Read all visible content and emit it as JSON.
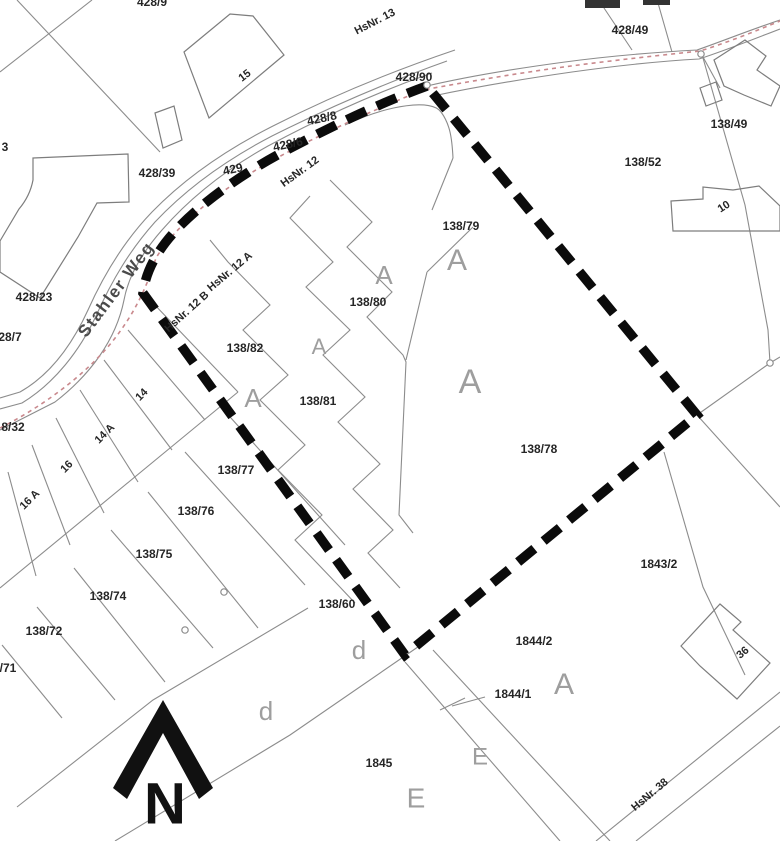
{
  "map": {
    "width": 780,
    "height": 841,
    "colors": {
      "background": "#ffffff",
      "thin_line": "#8c8c8c",
      "building_line": "#7d7d7d",
      "boundary": "#0b0b0b",
      "pink_dash": "#c9898d",
      "number_text": "#262626",
      "gray_letter": "#9e9e9e",
      "street_text": "#4a4a4a",
      "north": "#111111"
    },
    "boundary_outline": {
      "path": "M427,86 C380,103 330,127 285,151 C245,172 205,200 178,228 C158,249 146,270 143,293 L405,655 L697,415 Z",
      "stroke_width": 9.5,
      "dash": "21 12"
    },
    "pink_boundary": {
      "path": "M0,428 C40,408 92,372 121,330 C139,305 149,280 156,258 C176,225 216,193 266,164 C316,136 371,111 423,90 C471,81 526,72 571,66 C616,60 663,55 700,51 C726,43 756,31 780,21",
      "dash": "4 4",
      "stroke_width": 1.6
    },
    "road_paths": [
      "M455,50 C390,72 330,97 275,125 C225,150 185,178 152,212 C125,240 105,272 88,310 C72,345 50,375 20,392 L0,398",
      "M447,61 C385,83 328,108 272,136 C224,161 186,189 155,222 C130,250 112,280 96,316 C80,350 55,383 22,403 L0,409",
      "M432,73 C375,93 320,118 268,146 C225,170 190,198 162,230 C140,255 128,278 124,300 C116,340 90,375 55,402 L0,430",
      "M427,86 C470,76 520,68 565,62 C610,56 660,52 697,50 C720,42 750,30 780,20",
      "M433,96 C480,86 530,78 572,72 C615,66 662,61 699,59 C724,51 754,39 780,29",
      "M345,125 C390,104 432,99 441,112 C450,124 452,138 453,158"
    ],
    "parcel_polylines": [
      [
        [
          17,
          0
        ],
        [
          160,
          152
        ]
      ],
      [
        [
          92,
          0
        ],
        [
          0,
          72
        ]
      ],
      [
        [
          453,
          158
        ],
        [
          432,
          210
        ]
      ],
      [
        [
          238,
          392
        ],
        [
          0,
          588
        ]
      ],
      [
        [
          152,
          302
        ],
        [
          238,
          392
        ]
      ],
      [
        [
          128,
          330
        ],
        [
          205,
          420
        ]
      ],
      [
        [
          104,
          360
        ],
        [
          172,
          450
        ]
      ],
      [
        [
          80,
          390
        ],
        [
          138,
          482
        ]
      ],
      [
        [
          56,
          418
        ],
        [
          104,
          513
        ]
      ],
      [
        [
          32,
          445
        ],
        [
          70,
          545
        ]
      ],
      [
        [
          8,
          472
        ],
        [
          36,
          576
        ]
      ],
      [
        [
          222,
          408
        ],
        [
          345,
          545
        ]
      ],
      [
        [
          185,
          452
        ],
        [
          305,
          585
        ]
      ],
      [
        [
          148,
          492
        ],
        [
          258,
          628
        ]
      ],
      [
        [
          111,
          530
        ],
        [
          213,
          648
        ]
      ],
      [
        [
          74,
          568
        ],
        [
          165,
          682
        ]
      ],
      [
        [
          37,
          607
        ],
        [
          115,
          700
        ]
      ],
      [
        [
          2,
          645
        ],
        [
          62,
          718
        ]
      ],
      [
        [
          308,
          608
        ],
        [
          153,
          700
        ],
        [
          17,
          807
        ]
      ],
      [
        [
          428,
          640
        ],
        [
          290,
          735
        ],
        [
          115,
          841
        ]
      ],
      [
        [
          405,
          662
        ],
        [
          560,
          841
        ]
      ],
      [
        [
          433,
          650
        ],
        [
          610,
          841
        ]
      ],
      [
        [
          485,
          697
        ],
        [
          452,
          706
        ]
      ],
      [
        [
          440,
          710
        ],
        [
          465,
          698
        ]
      ],
      [
        [
          596,
          841
        ],
        [
          780,
          692
        ]
      ],
      [
        [
          636,
          841
        ],
        [
          780,
          726
        ]
      ],
      [
        [
          697,
          415
        ],
        [
          780,
          507
        ]
      ],
      [
        [
          664,
          452
        ],
        [
          703,
          587
        ],
        [
          745,
          675
        ]
      ],
      [
        [
          703,
          58
        ],
        [
          745,
          205
        ],
        [
          768,
          330
        ],
        [
          770,
          363
        ]
      ],
      [
        [
          770,
          363
        ],
        [
          697,
          415
        ]
      ],
      [
        [
          770,
          363
        ],
        [
          780,
          357
        ]
      ],
      [
        [
          602,
          5
        ],
        [
          632,
          50
        ]
      ],
      [
        [
          658,
          3
        ],
        [
          672,
          52
        ]
      ],
      [
        [
          720,
          88
        ],
        [
          703,
          57
        ]
      ],
      [
        [
          427,
          272
        ],
        [
          406,
          360
        ]
      ],
      [
        [
          427,
          272
        ],
        [
          473,
          227
        ]
      ]
    ],
    "zigzag_polylines": [
      [
        [
          330,
          180
        ],
        [
          372,
          222
        ],
        [
          347,
          247
        ],
        [
          392,
          292
        ],
        [
          367,
          317
        ],
        [
          403,
          355
        ],
        [
          406,
          362
        ],
        [
          399,
          515
        ],
        [
          413,
          533
        ]
      ],
      [
        [
          310,
          196
        ],
        [
          290,
          218
        ],
        [
          333,
          262
        ],
        [
          306,
          287
        ],
        [
          350,
          330
        ],
        [
          323,
          355
        ],
        [
          365,
          397
        ],
        [
          338,
          422
        ],
        [
          380,
          464
        ],
        [
          353,
          489
        ],
        [
          393,
          530
        ],
        [
          368,
          553
        ],
        [
          400,
          588
        ]
      ],
      [
        [
          210,
          240
        ],
        [
          228,
          262
        ],
        [
          270,
          305
        ],
        [
          243,
          330
        ],
        [
          288,
          375
        ],
        [
          260,
          400
        ],
        [
          305,
          445
        ],
        [
          278,
          470
        ],
        [
          322,
          515
        ],
        [
          295,
          540
        ],
        [
          338,
          585
        ],
        [
          355,
          603
        ]
      ]
    ],
    "buildings": [
      {
        "name": "building-15",
        "path": "M184,52 L230,14 L253,16 L284,55 L209,118 Z"
      },
      {
        "name": "building-small-road",
        "path": "M155,113 L174,106 L182,140 L163,148 Z"
      },
      {
        "name": "building-17",
        "path": "M33,158 L128,154 L129,202 L97,203 L78,237 L40,298 L0,272 L0,241 L19,209 Q30,196 33,180 Z"
      },
      {
        "name": "building-top-right",
        "path": "M714,60 L745,40 L766,56 L757,70 L780,86 L771,106 L744,95 L724,86 Z"
      },
      {
        "name": "building-top-right-annex",
        "path": "M700,88 L716,82 L722,100 L706,106 Z"
      },
      {
        "name": "building-10",
        "path": "M671,201 L703,199 L703,187 L733,190 L759,186 L780,206 L780,231 L673,231 Z"
      },
      {
        "name": "building-36",
        "path": "M681,646 L720,604 L741,622 L733,630 L770,663 L737,699 L700,666 Z"
      }
    ],
    "filled_structures": [
      {
        "name": "top-edge-structure",
        "path": "M585,0 L620,0 L620,8 L585,8 Z"
      },
      {
        "name": "top-edge-structure",
        "path": "M643,0 L670,0 L670,5 L643,5 Z"
      }
    ],
    "survey_points": [
      {
        "x": 427,
        "y": 85
      },
      {
        "x": 701,
        "y": 54
      },
      {
        "x": 770,
        "y": 363
      },
      {
        "x": 185,
        "y": 630
      },
      {
        "x": 224,
        "y": 592
      }
    ],
    "labels": [
      {
        "t": "428/9",
        "x": 152,
        "y": 3,
        "s": 12,
        "rot": 0,
        "c": "n"
      },
      {
        "t": "HsNr. 13",
        "x": 375,
        "y": 22,
        "s": 11,
        "rot": -27,
        "c": "n"
      },
      {
        "t": "428/90",
        "x": 414,
        "y": 78,
        "s": 12,
        "rot": 0,
        "c": "n"
      },
      {
        "t": "428/49",
        "x": 630,
        "y": 31,
        "s": 12,
        "rot": 0,
        "c": "n"
      },
      {
        "t": "138/49",
        "x": 729,
        "y": 125,
        "s": 12,
        "rot": 0,
        "c": "n"
      },
      {
        "t": "138/52",
        "x": 643,
        "y": 163,
        "s": 12,
        "rot": 0,
        "c": "n"
      },
      {
        "t": "10",
        "x": 724,
        "y": 207,
        "s": 11,
        "rot": -33,
        "c": "n"
      },
      {
        "t": "15",
        "x": 245,
        "y": 76,
        "s": 11,
        "rot": -38,
        "c": "n"
      },
      {
        "t": "428/39",
        "x": 157,
        "y": 174,
        "s": 12,
        "rot": 0,
        "c": "n"
      },
      {
        "t": "428/8",
        "x": 322,
        "y": 119,
        "s": 12,
        "rot": -12,
        "c": "n"
      },
      {
        "t": "428/6",
        "x": 288,
        "y": 145,
        "s": 12,
        "rot": -12,
        "c": "n"
      },
      {
        "t": "429",
        "x": 233,
        "y": 170,
        "s": 12,
        "rot": -12,
        "c": "n"
      },
      {
        "t": "HsNr. 12",
        "x": 300,
        "y": 172,
        "s": 11,
        "rot": -36,
        "c": "n"
      },
      {
        "t": "HsNr. 12 A",
        "x": 230,
        "y": 272,
        "s": 11,
        "rot": -40,
        "c": "n"
      },
      {
        "t": "HsNr. 12 B",
        "x": 187,
        "y": 312,
        "s": 11,
        "rot": -42,
        "c": "n"
      },
      {
        "t": "Stahler Weg",
        "x": 117,
        "y": 290,
        "s": 17,
        "rot": -53,
        "c": "s"
      },
      {
        "t": "428/23",
        "x": 34,
        "y": 298,
        "s": 12,
        "rot": 0,
        "c": "n"
      },
      {
        "t": "28/7",
        "x": 10,
        "y": 338,
        "s": 12,
        "rot": 0,
        "c": "n"
      },
      {
        "t": "3",
        "x": 5,
        "y": 148,
        "s": 12,
        "rot": 0,
        "c": "n"
      },
      {
        "t": "138/79",
        "x": 461,
        "y": 227,
        "s": 12,
        "rot": 0,
        "c": "n"
      },
      {
        "t": "A",
        "x": 457,
        "y": 262,
        "s": 30,
        "rot": 0,
        "c": "g"
      },
      {
        "t": "A",
        "x": 384,
        "y": 277,
        "s": 26,
        "rot": 0,
        "c": "g"
      },
      {
        "t": "138/80",
        "x": 368,
        "y": 303,
        "s": 12,
        "rot": 0,
        "c": "n"
      },
      {
        "t": "138/82",
        "x": 245,
        "y": 349,
        "s": 12,
        "rot": 0,
        "c": "n"
      },
      {
        "t": "A",
        "x": 319,
        "y": 348,
        "s": 22,
        "rot": 0,
        "c": "g"
      },
      {
        "t": "A",
        "x": 253,
        "y": 400,
        "s": 26,
        "rot": 0,
        "c": "g"
      },
      {
        "t": "138/81",
        "x": 318,
        "y": 402,
        "s": 12,
        "rot": 0,
        "c": "n"
      },
      {
        "t": "A",
        "x": 470,
        "y": 384,
        "s": 34,
        "rot": 0,
        "c": "g"
      },
      {
        "t": "138/78",
        "x": 539,
        "y": 450,
        "s": 12,
        "rot": 0,
        "c": "n"
      },
      {
        "t": "8/32",
        "x": 13,
        "y": 428,
        "s": 12,
        "rot": 0,
        "c": "n"
      },
      {
        "t": "14",
        "x": 142,
        "y": 395,
        "s": 11,
        "rot": -45,
        "c": "n"
      },
      {
        "t": "14 A",
        "x": 105,
        "y": 434,
        "s": 11,
        "rot": -45,
        "c": "n"
      },
      {
        "t": "16",
        "x": 67,
        "y": 467,
        "s": 11,
        "rot": -45,
        "c": "n"
      },
      {
        "t": "16 A",
        "x": 30,
        "y": 500,
        "s": 11,
        "rot": -45,
        "c": "n"
      },
      {
        "t": "138/77",
        "x": 236,
        "y": 471,
        "s": 12,
        "rot": 0,
        "c": "n"
      },
      {
        "t": "138/76",
        "x": 196,
        "y": 512,
        "s": 12,
        "rot": 0,
        "c": "n"
      },
      {
        "t": "138/75",
        "x": 154,
        "y": 555,
        "s": 12,
        "rot": 0,
        "c": "n"
      },
      {
        "t": "138/74",
        "x": 108,
        "y": 597,
        "s": 12,
        "rot": 0,
        "c": "n"
      },
      {
        "t": "138/72",
        "x": 44,
        "y": 632,
        "s": 12,
        "rot": 0,
        "c": "n"
      },
      {
        "t": "/71",
        "x": 8,
        "y": 669,
        "s": 12,
        "rot": 0,
        "c": "n"
      },
      {
        "t": "138/60",
        "x": 337,
        "y": 605,
        "s": 12,
        "rot": 0,
        "c": "n"
      },
      {
        "t": "d",
        "x": 359,
        "y": 652,
        "s": 26,
        "rot": 0,
        "c": "g"
      },
      {
        "t": "d",
        "x": 266,
        "y": 713,
        "s": 26,
        "rot": 0,
        "c": "g"
      },
      {
        "t": "1843/2",
        "x": 659,
        "y": 565,
        "s": 12,
        "rot": 0,
        "c": "n"
      },
      {
        "t": "36",
        "x": 743,
        "y": 653,
        "s": 11,
        "rot": -40,
        "c": "n"
      },
      {
        "t": "1844/2",
        "x": 534,
        "y": 642,
        "s": 12,
        "rot": 0,
        "c": "n"
      },
      {
        "t": "1844/1",
        "x": 513,
        "y": 695,
        "s": 12,
        "rot": 0,
        "c": "n"
      },
      {
        "t": "A",
        "x": 564,
        "y": 686,
        "s": 30,
        "rot": 0,
        "c": "g"
      },
      {
        "t": "1845",
        "x": 379,
        "y": 764,
        "s": 12,
        "rot": 0,
        "c": "n"
      },
      {
        "t": "E",
        "x": 480,
        "y": 758,
        "s": 24,
        "rot": 0,
        "c": "g"
      },
      {
        "t": "E",
        "x": 416,
        "y": 800,
        "s": 28,
        "rot": 0,
        "c": "g"
      },
      {
        "t": "HsNr. 38",
        "x": 650,
        "y": 795,
        "s": 11,
        "rot": -40,
        "c": "n"
      }
    ],
    "north_arrow": {
      "polygon": "163,700 213,788 199,799 163,733 127,799 113,788",
      "label": "N",
      "label_x": 165,
      "label_y": 808,
      "label_size": 58
    }
  }
}
